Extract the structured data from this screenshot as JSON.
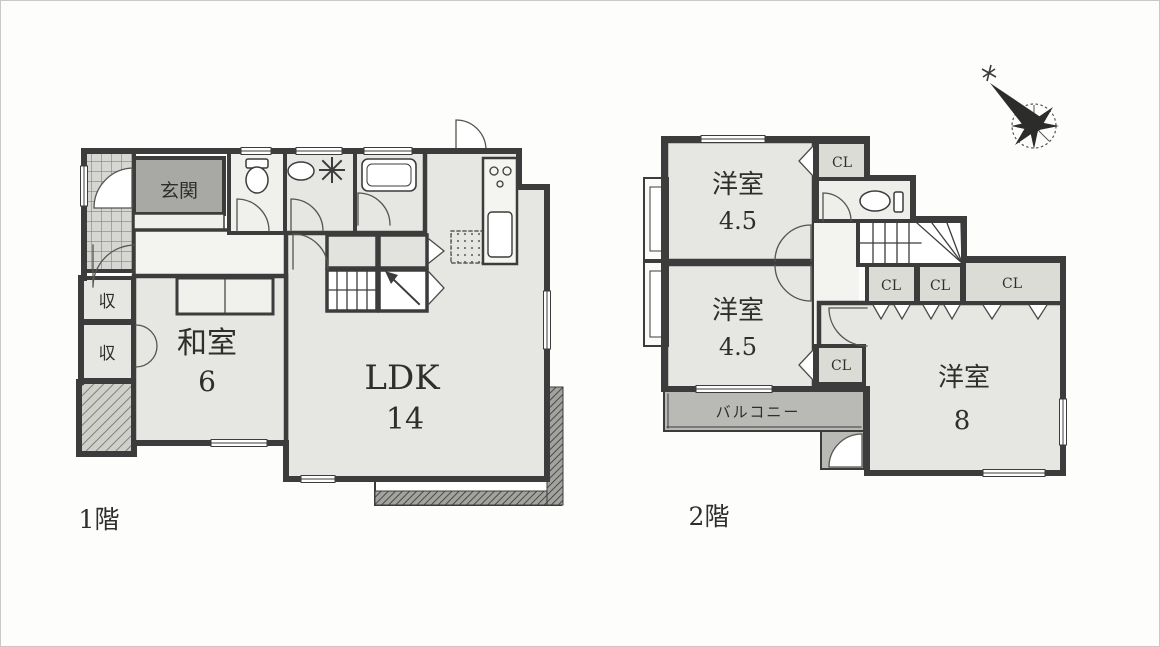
{
  "floor1": {
    "caption": "1階",
    "genkan": {
      "label": "玄関"
    },
    "washitsu": {
      "name": "和室",
      "size": "6"
    },
    "ldk": {
      "name": "LDK",
      "size": "14"
    },
    "storage_top": {
      "label": "収"
    },
    "storage_bottom": {
      "label": "収"
    }
  },
  "floor2": {
    "caption": "2階",
    "room_top": {
      "name": "洋室",
      "size": "4.5"
    },
    "room_mid": {
      "name": "洋室",
      "size": "4.5"
    },
    "room_big": {
      "name": "洋室",
      "size": "8"
    },
    "balcony": {
      "label": "バルコニー"
    },
    "closets": [
      {
        "label": "CL"
      },
      {
        "label": "CL"
      },
      {
        "label": "CL"
      },
      {
        "label": "CL"
      },
      {
        "label": "CL"
      }
    ]
  },
  "icons": {
    "compass": "compass-rose-north"
  },
  "colors": {
    "wall": "#3c3c3c",
    "room_fill": "#e6e6e2",
    "hall_fill": "#f3f3ef",
    "genkan_fill": "#a8a9a5",
    "balcony_fill": "#b9bab6",
    "closet_fill": "#dcdcd7",
    "background": "#fdfdfc"
  }
}
